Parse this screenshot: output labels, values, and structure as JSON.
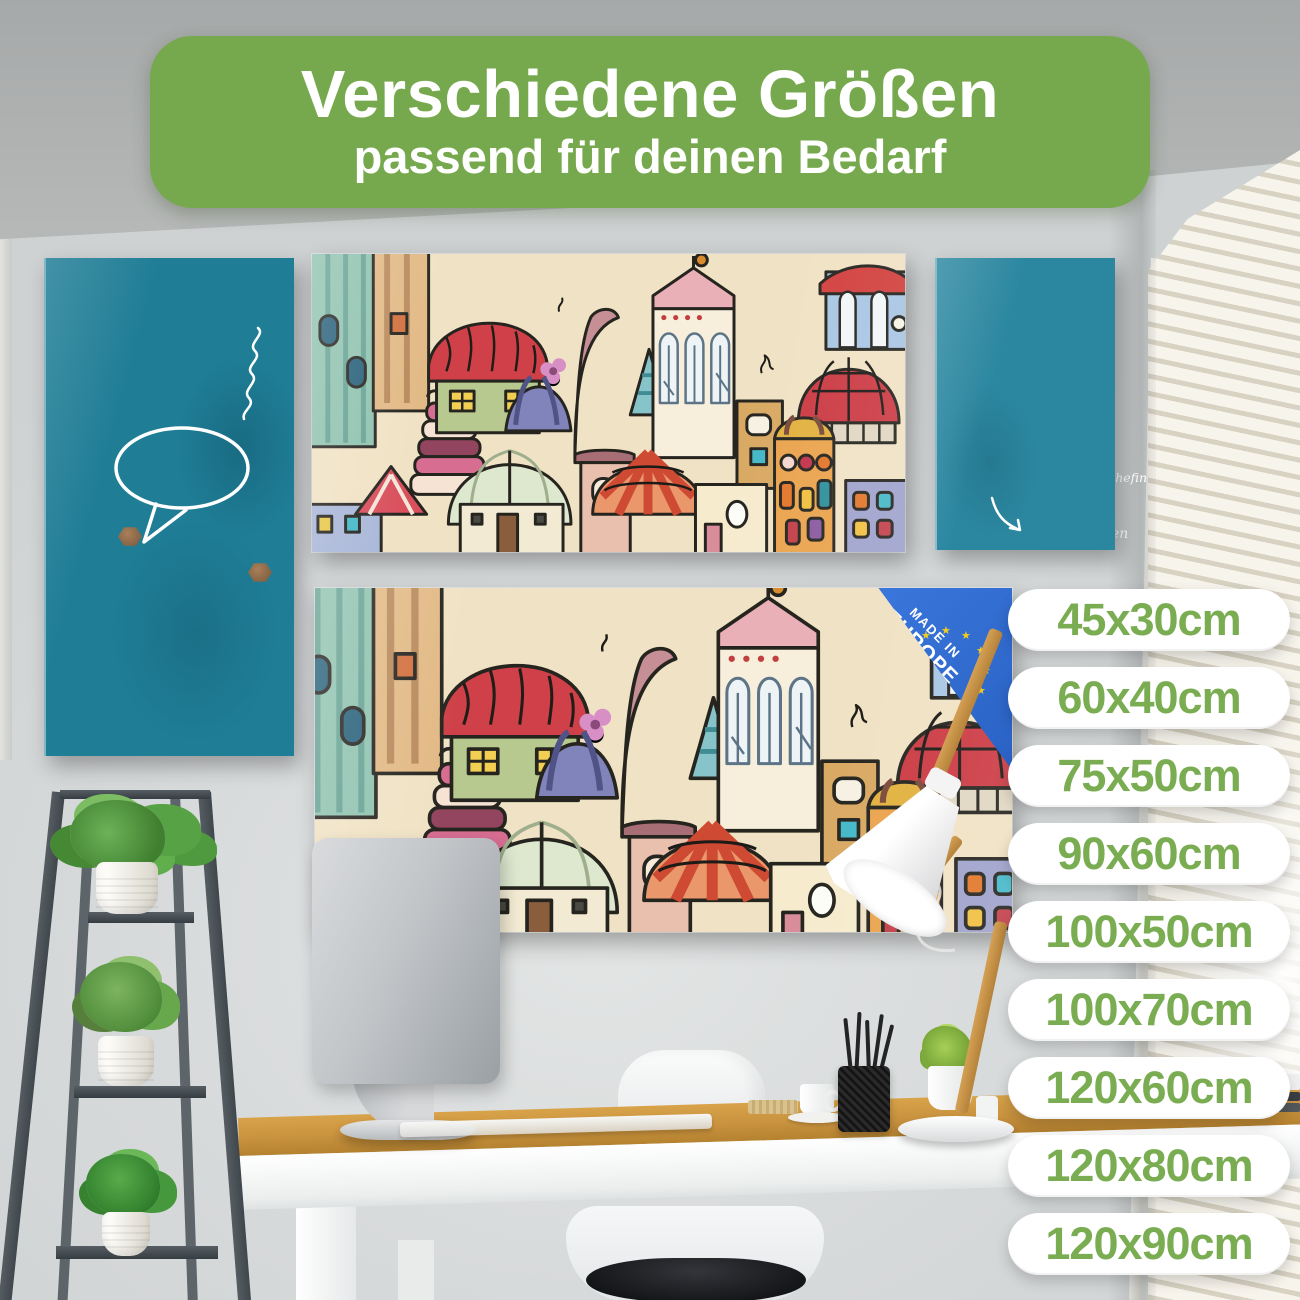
{
  "banner": {
    "line1": "Verschiedene Größen",
    "line2": "passend für deinen Bedarf"
  },
  "sizes": [
    "45x30cm",
    "60x40cm",
    "75x50cm",
    "90x60cm",
    "100x50cm",
    "100x70cm",
    "120x60cm",
    "120x80cm",
    "120x90cm"
  ],
  "left_board": {
    "sticky_notes": {
      "note_shopping": "Kaffee\nMilch\nBrot",
      "note_address": "Annika Friedrich\n0123 45 67 89\nNeue Straße 78\n01234 Perleberg",
      "note_gift": "Geschenk für\nMama\nabholen",
      "note_misc": "IP Auswahl\n2018"
    },
    "bubble": {
      "line1": "Work smarter,",
      "line2": "not harder"
    },
    "document": {
      "title": "Angebot",
      "brand": "banjado"
    }
  },
  "right_board": {
    "flyer": {
      "brand": "banjado",
      "thanks": "DANKE!!!"
    },
    "notes": [
      "Termine:",
      "12:30 Uhr Teammeeting",
      "14:00 Uhr Gespräch mit Chefin"
    ],
    "reminder": {
      "line1": "Kuchen",
      "line2": "nicht vergessen",
      "smiley": "☺"
    }
  },
  "badge": {
    "line1": "MADE IN",
    "line2": "EUROPE"
  },
  "colors": {
    "banner_green": "#76a94d",
    "pill_green": "#7aad52",
    "board_teal_left": "#1f7d96",
    "board_teal_right": "#2b87a0",
    "badge_blue": "#2f6fd4",
    "star_yellow": "#f2cf1f",
    "desk_wood": "#c8923f"
  }
}
